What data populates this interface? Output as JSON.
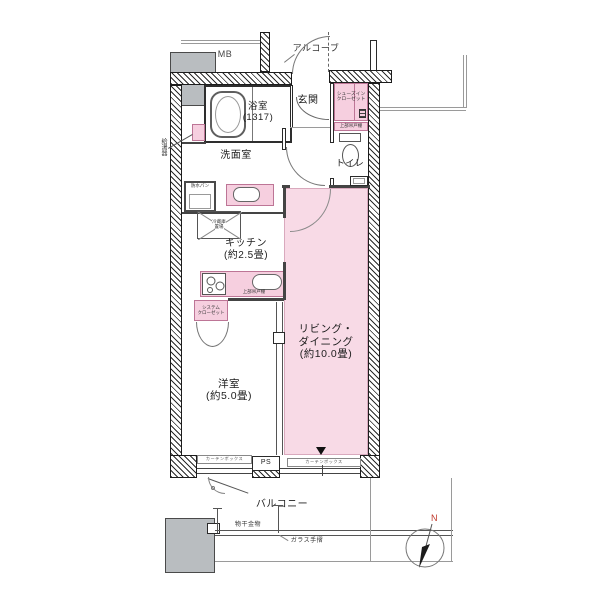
{
  "plan": {
    "title": "apartment-floor-plan",
    "labels": {
      "mb": "MB",
      "alcove": "アルコーブ",
      "bath_name": "浴室",
      "bath_size": "(1317)",
      "entrance": "玄関",
      "sic_line1": "シューズイン",
      "sic_line2": "クローゼット",
      "upper_cabinet": "上部吊戸棚",
      "toilet": "トイレ",
      "washroom": "洗面室",
      "water_heater": "給湯器",
      "waterproof_pan": "防水パン",
      "fridge_line1": "冷蔵庫",
      "fridge_line2": "置場",
      "kitchen_name": "キッチン",
      "kitchen_size": "(約2.5畳)",
      "closet_line1": "システム",
      "closet_line2": "クローゼット",
      "ld_line1": "リビング・",
      "ld_line2": "ダイニング",
      "ld_size": "(約10.0畳)",
      "western_name": "洋室",
      "western_size": "(約5.0畳)",
      "curtain_box": "カーテンボックス",
      "ps": "PS",
      "balcony": "バルコニー",
      "laundry_fitting": "物干金物",
      "glass_rail": "ガラス手摺",
      "compass_n": "N"
    },
    "colors": {
      "room_pink": "#f8dae6",
      "closet_pink": "#f6cfdf",
      "wall_dark": "#2b2b2b",
      "gray_block": "#b9bdc0",
      "compass_n_red": "#c0392b"
    }
  }
}
